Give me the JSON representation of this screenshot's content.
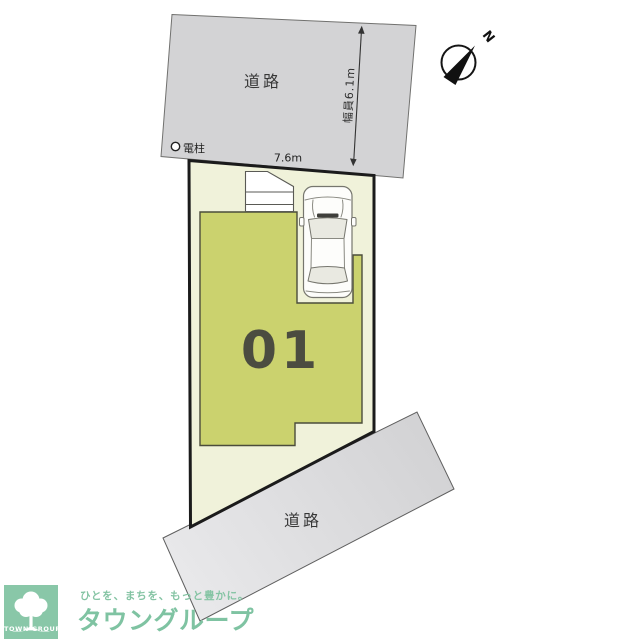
{
  "plan": {
    "top_road_label": "道路",
    "top_road_width": "幅員6.1m",
    "frontage": "7.6m",
    "utility_pole": "電柱",
    "lot_number": "01",
    "bottom_road_label": "道路",
    "compass_north": "N"
  },
  "logo": {
    "tagline": "ひとを、まちを、もっと豊かに。",
    "brand_name": "タウングループ",
    "badge_text": "TOWN GROUP"
  },
  "colors": {
    "road_fill": "#d3d3d5",
    "road_fill_light": "#e9e9eb",
    "lot_fill": "#f0f2da",
    "lot_border": "#1b1b1b",
    "building_fill": "#cbd26e",
    "building_border": "#4b4c3b",
    "structure_fill": "#ffffff",
    "car_body": "#fdfdfb",
    "car_glass": "#e9e9e1",
    "car_outline": "#76766e",
    "brand_green": "#89c7a8",
    "needle_black": "#111111"
  }
}
